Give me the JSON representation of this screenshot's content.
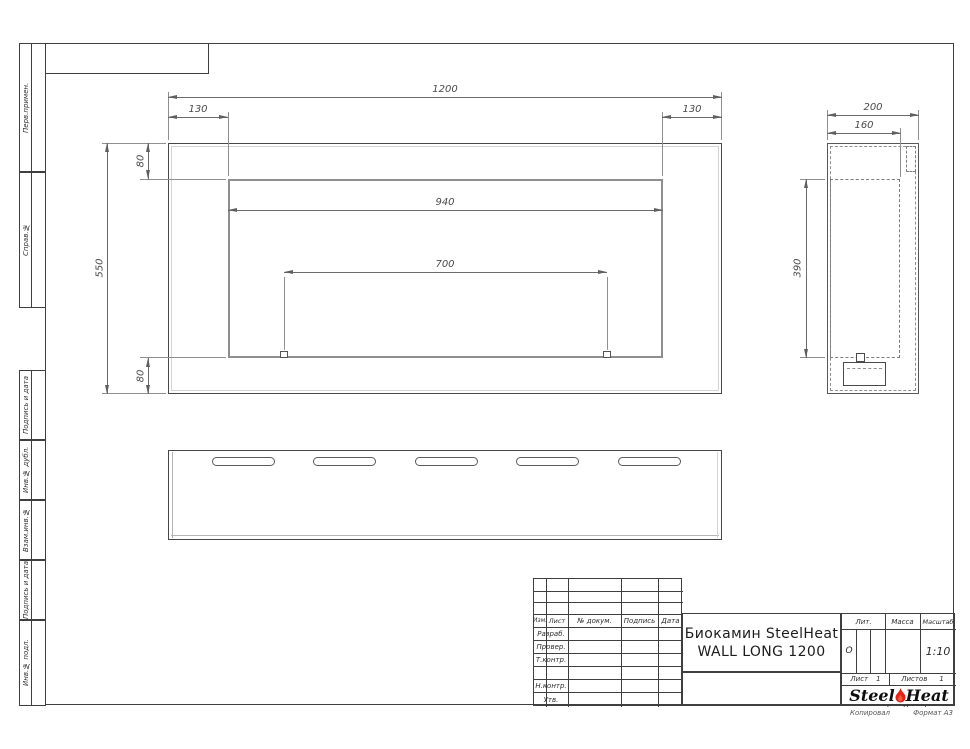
{
  "frame": {
    "left_stamps": [
      {
        "label": "Перв.примен."
      },
      {
        "label": "Справ.№"
      },
      {
        "label": "Подпись и дата"
      },
      {
        "label": "Инв.№ дубл."
      },
      {
        "label": "Взам.инв.№"
      },
      {
        "label": "Подпись и дата"
      },
      {
        "label": "Инв.№ подл."
      }
    ],
    "footer": {
      "copied": "Копировал",
      "format": "Формат А3"
    }
  },
  "title_block": {
    "revision_header": {
      "izm": "Изм.",
      "list": "Лист",
      "doc": "№ докум.",
      "sign": "Подпись",
      "date": "Дата"
    },
    "role_rows": [
      {
        "label": "Разраб."
      },
      {
        "label": "Провер."
      },
      {
        "label": "Т.контр."
      },
      {
        "label": ""
      },
      {
        "label": "Н.контр."
      },
      {
        "label": "Утв."
      }
    ],
    "title_line1": "Биокамин SteelHeat",
    "title_line2": "WALL LONG 1200",
    "lit": {
      "label": "Лит.",
      "value": "О"
    },
    "mass": {
      "label": "Масса",
      "value": ""
    },
    "scale": {
      "label": "Масштаб",
      "value": "1:10"
    },
    "sheet": {
      "label": "Лист",
      "value": "1"
    },
    "sheets": {
      "label": "Листов",
      "value": "1"
    },
    "logo": {
      "word1": "Steel",
      "word2": "Heat",
      "site": "www.steelheat.ru"
    }
  },
  "drawing": {
    "front_view": {
      "dims": {
        "overall_width": "1200",
        "left_inset": "130",
        "right_inset": "130",
        "top_inset": "80",
        "overall_height": "550",
        "bottom_inset": "80",
        "opening_width": "940",
        "mount_span": "700"
      }
    },
    "side_view": {
      "dims": {
        "depth": "200",
        "inner_depth": "160",
        "opening_height": "390"
      }
    }
  }
}
